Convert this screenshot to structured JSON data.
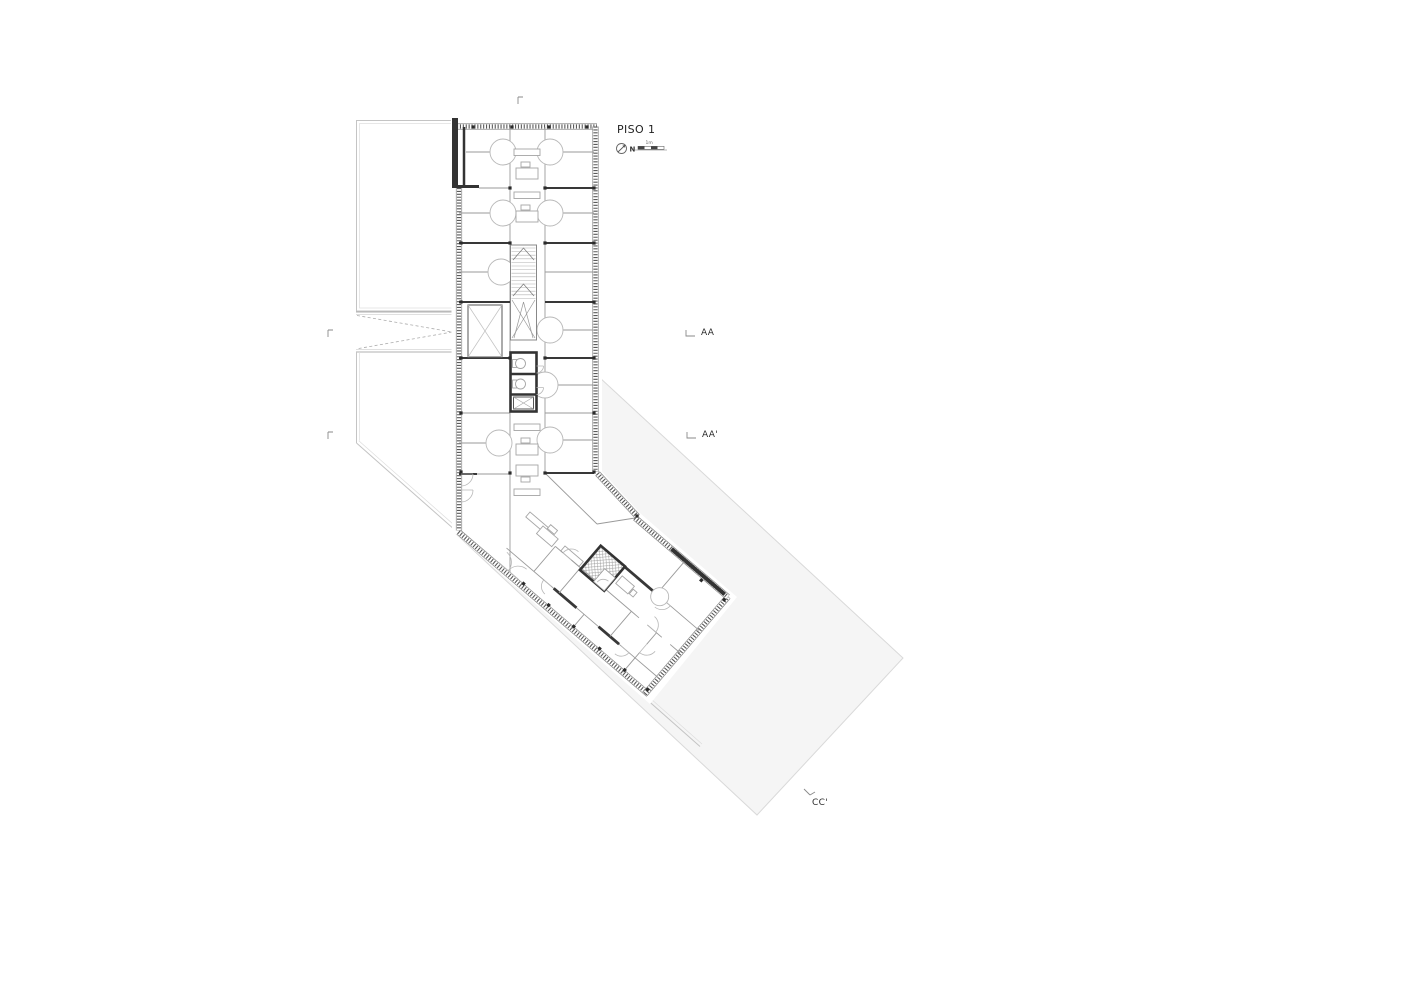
{
  "title": {
    "text": "PISO 1"
  },
  "compass": {
    "label": "N"
  },
  "scale_bar": {
    "label": "1m"
  },
  "sections": {
    "aa": {
      "label": "AA"
    },
    "aa_prime": {
      "label": "AA'"
    },
    "cc_prime": {
      "label": "CC'"
    }
  },
  "colors": {
    "background": "#ffffff",
    "site_fill": "#f5f5f5",
    "site_stroke": "#d9d9d9",
    "wall_dark": "#333333",
    "wall_hatch": "#5a5a5a",
    "line_thin": "#9a9a9a",
    "text": "#1f1f1f"
  }
}
